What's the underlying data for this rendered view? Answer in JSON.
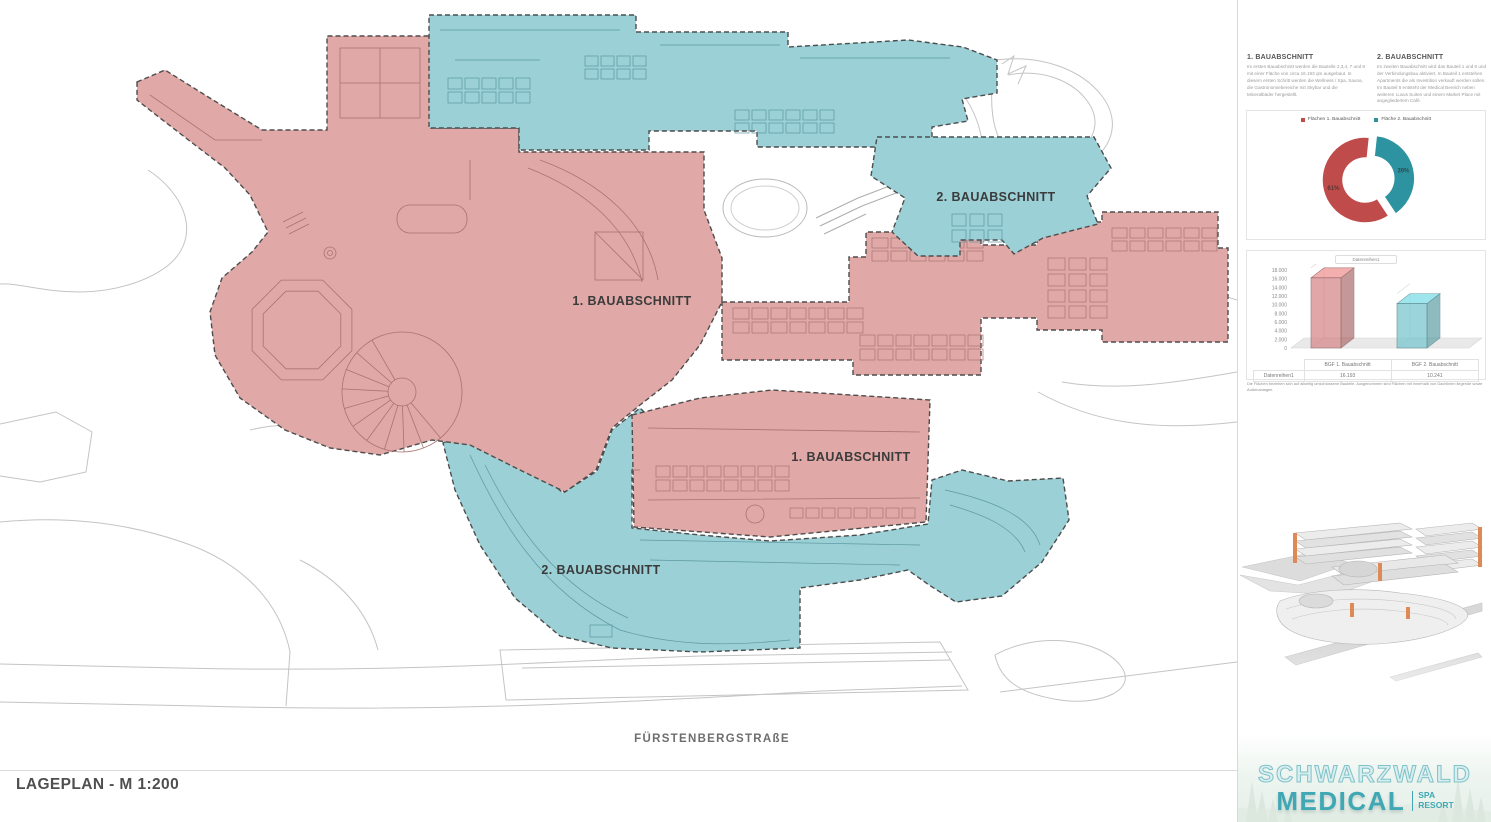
{
  "page": {
    "title_block": "LAGEPLAN - M 1:200",
    "street_label": "FÜRSTENBERGSTRAßE"
  },
  "plan": {
    "labels": {
      "phase1_main": "1. BAUABSCHNITT",
      "phase2_upper": "2. BAUABSCHNITT",
      "phase1_lower": "1. BAUABSCHNITT",
      "phase2_lower": "2. BAUABSCHNITT"
    },
    "colors": {
      "phase1_fill": "#E0A8A6",
      "phase1_line": "#A87472",
      "phase2_fill": "#9AD0D6",
      "phase2_line": "#5E98A2",
      "boundary": "#4D4D4D",
      "context": "#C4C4C4"
    }
  },
  "sidebar": {
    "sections": [
      {
        "heading": "1. BAUABSCHNITT",
        "body": "Im ersten Bauabschnitt werden die Bauteile 2,3,4, 7 und 8 mit einer Fläche von circa 16.193 qm ausgebaut. In diesem ersten Schritt werden die Wellness / Spa, Sauna, die Gastronomiebereiche mit Skybar und die Mineralbäder hergestellt."
      },
      {
        "heading": "2. BAUABSCHNITT",
        "body": "Im zweiten Bauabschnitt wird das Bauteil 1 und 5 und der Verbindungsbau aktiviert. In Bauteil 1 entstehen Apartments die als Investition verkauft werden sollen. Im Bauteil 5 entsteht der Medical Bereich neben weiteren Luxus Suiten und einem Market Place mit angegliedertem Café."
      }
    ],
    "disclaimer": "Die Flächen beziehen sich auf allseitig umschlossene Bauteile. Ausgenommen sind Flächen mit innerhalb von Dachlinien liegende sowie Außenanlagen.",
    "logo": {
      "line1": "SCHWARZWALD",
      "line2": "MEDICAL",
      "tag_top": "SPA",
      "tag_bottom": "RESORT",
      "color": "#3FA8B4"
    }
  },
  "chart_data": [
    {
      "type": "pie",
      "donut": true,
      "legend": [
        "Flächen 1. Bauabschnitt",
        "Fläche 2. Bauabschnitt"
      ],
      "values": [
        61,
        39
      ],
      "value_labels": [
        "61%",
        "39%"
      ],
      "colors": [
        "#C04B4B",
        "#2E93A0"
      ],
      "legend_position": "top",
      "exploded_index": 1,
      "rotation_deg": 6,
      "draw_order": [
        1,
        0
      ]
    },
    {
      "type": "bar",
      "style": "3d",
      "legend": "Datenreihen1",
      "categories": [
        "BGF 1. Bauabschnitt",
        "BGF 2. Bauabschnitt"
      ],
      "series": [
        {
          "name": "Datenreihen1",
          "values": [
            16193,
            10241
          ],
          "value_labels": [
            "16.193",
            "10.241"
          ]
        }
      ],
      "colors": [
        "#D88F90",
        "#7FC9D1"
      ],
      "ylim": [
        0,
        18000
      ],
      "ytick_step": 2000,
      "ytick_labels": [
        "0",
        "2.000",
        "4.000",
        "6.000",
        "8.000",
        "10.000",
        "12.000",
        "14.000",
        "16.000",
        "18.000"
      ],
      "grid": false,
      "legend_position": "top"
    }
  ]
}
